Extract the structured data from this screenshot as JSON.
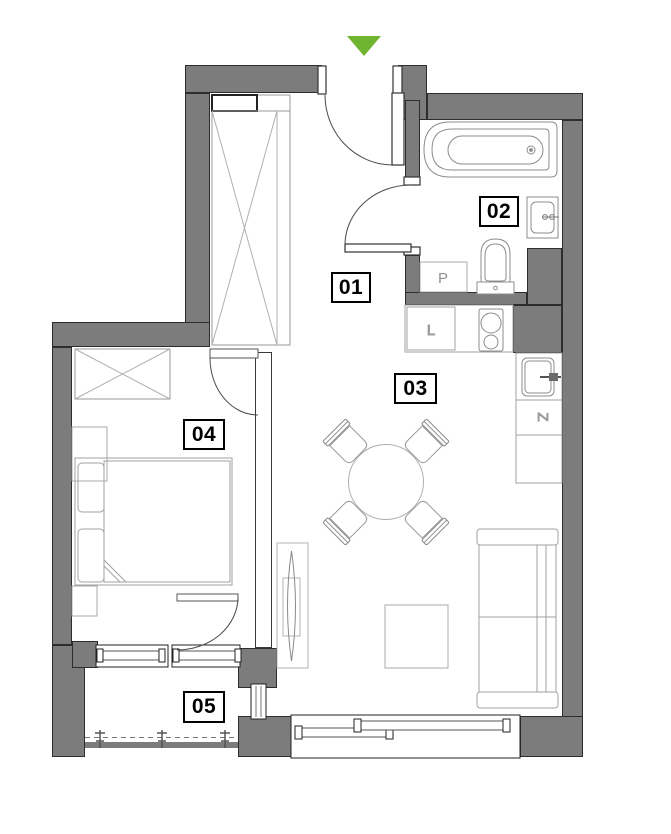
{
  "plan": {
    "type": "apartment-floor-plan",
    "entrance_marker": {
      "icon": "triangle-down",
      "color": "#6fb52f"
    },
    "rooms": [
      {
        "number": "01"
      },
      {
        "number": "02"
      },
      {
        "number": "03"
      },
      {
        "number": "04"
      },
      {
        "number": "05"
      }
    ],
    "appliance_labels": {
      "washing_machine": "P",
      "fridge": "L",
      "dishwasher": "Z"
    },
    "colors": {
      "wall": "#7c7c7c",
      "wall_outline": "#2d2d2d",
      "furniture_line": "#a0a0a0",
      "entrance_marker": "#6fb52f"
    }
  }
}
